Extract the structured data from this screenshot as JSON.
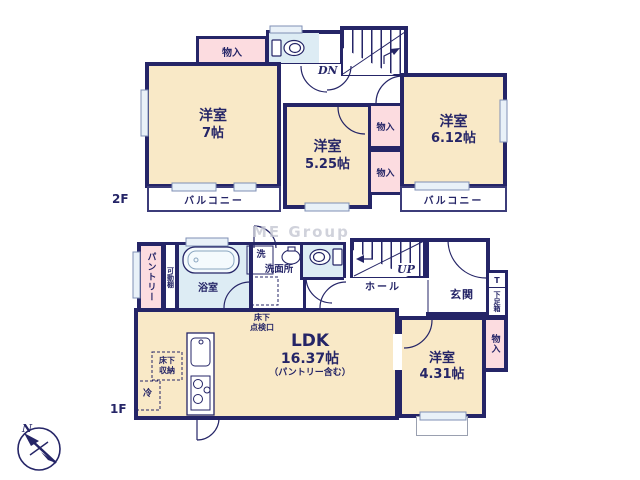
{
  "watermark": "ME Group",
  "compass": {
    "north": "N"
  },
  "colors": {
    "wall": "#252567",
    "room": "#f9e9c7",
    "closet": "#fcdce0",
    "wet_area": "#ddecf4"
  },
  "f2": {
    "label": "2F",
    "closet_top": "物入",
    "dn": "DN",
    "room_w": {
      "name": "洋室",
      "size": "7帖"
    },
    "room_c": {
      "name": "洋室",
      "size": "5.25帖"
    },
    "room_e": {
      "name": "洋室",
      "size": "6.12帖"
    },
    "closet_u": "物入",
    "closet_l": "物入",
    "balcony_w": "バルコニー",
    "balcony_e": "バルコニー"
  },
  "f1": {
    "label": "1F",
    "pantry": "パントリー",
    "shelf": "可動棚",
    "bath": "浴室",
    "laundry": "洗",
    "washroom": "洗面所",
    "hatch": "床下\n点検口",
    "hall": "ホール",
    "up": "UP",
    "entrance": "玄関",
    "shoe_t": "T",
    "shoe": "下足箱",
    "closet_e": "物入",
    "ldk": {
      "name": "LDK",
      "size": "16.37帖",
      "note": "（パントリー含む）"
    },
    "room_s": {
      "name": "洋室",
      "size": "4.31帖"
    },
    "storage": "床下\n収納",
    "fridge": "冷"
  }
}
